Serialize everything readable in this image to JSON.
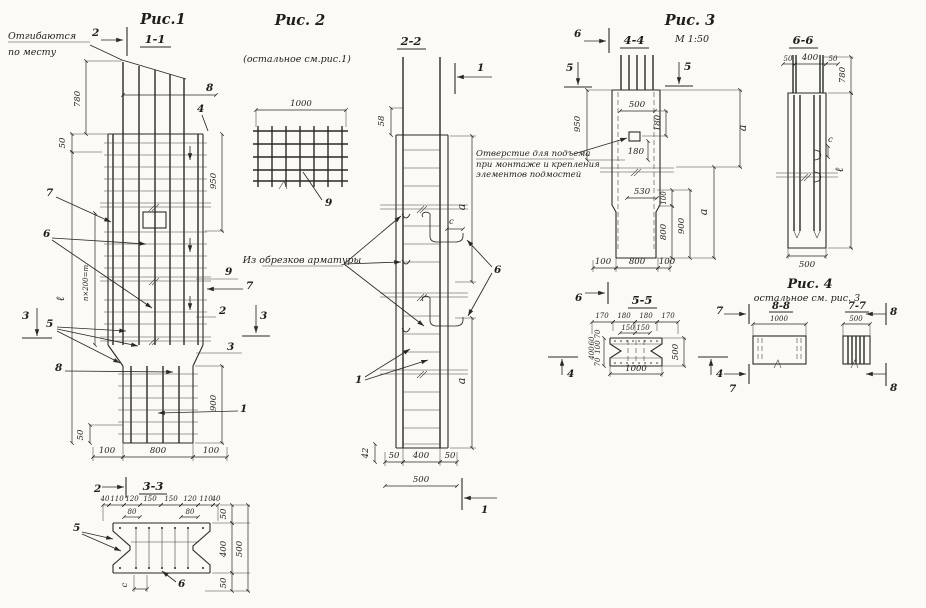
{
  "f1": {
    "title": "Рис.1",
    "sec": "1-1",
    "note1": "Отгибаются",
    "note2": "по месту",
    "cut2": "2",
    "d780": "780",
    "d50top": "50",
    "d8": "8",
    "c4": "4",
    "d950": "950",
    "c7l": "7",
    "c6": "6",
    "c9": "9",
    "c7r": "7",
    "c2": "2",
    "cut3r": "3",
    "c3": "3",
    "dl": "ℓ",
    "dpitch": "n×200=m",
    "cut3l": "3",
    "c5": "5",
    "c8": "8",
    "d900": "900",
    "c1": "1",
    "d50bot": "50",
    "d100l": "100",
    "d800": "800",
    "d100r": "100"
  },
  "s33": {
    "sec": "3-3",
    "cut2": "2",
    "top": [
      "40",
      "110",
      "120",
      "150",
      "150",
      "120",
      "110",
      "40"
    ],
    "d80l": "80",
    "d80r": "80",
    "d50t": "50",
    "d400": "400",
    "d500": "500",
    "d50b": "50",
    "c5": "5",
    "dc": "c",
    "c6": "6"
  },
  "f2": {
    "title": "Рис. 2",
    "note": "(остальное см.рис.1)",
    "d1000": "1000",
    "c9": "9"
  },
  "s22": {
    "sec": "2-2",
    "cut1t": "1",
    "d58": "58",
    "dc": "c",
    "da_top": "a",
    "c6": "6",
    "note": "Из обрезков арматуры",
    "c1": "1",
    "da_bot": "a",
    "d42": "42",
    "d50l": "50",
    "d400": "400",
    "d50r": "50",
    "d500": "500",
    "cut1b": "1"
  },
  "f3": {
    "title": "Рис. 3",
    "scale": "М 1:50",
    "sec": "4-4",
    "cut6t": "6",
    "cut5l": "5",
    "cut5r": "5",
    "d950": "950",
    "d500": "500",
    "d180a": "180",
    "d180b": "180",
    "hole1": "Отверстие для подъема",
    "hole2": "при монтаже и крепления",
    "hole3": "элементов подмостей",
    "da_top": "a",
    "d530": "530",
    "d100": "100",
    "d800": "800",
    "d900": "900",
    "da_bot": "a",
    "b100l": "100",
    "b800": "800",
    "b100r": "100",
    "cut6b": "6"
  },
  "s55": {
    "sec": "5-5",
    "top": [
      "170",
      "180",
      "180",
      "170"
    ],
    "mid": [
      "150",
      "150"
    ],
    "left": [
      "70",
      "60",
      "100",
      "400",
      "70"
    ],
    "d500": "500",
    "d1000": "1000",
    "cut4l": "4",
    "cut4r": "4"
  },
  "s66": {
    "sec": "6-6",
    "d50l": "50",
    "d400": "400",
    "d50r": "50",
    "d780": "780",
    "dc": "c",
    "dl": "ℓ",
    "d500": "500"
  },
  "f4": {
    "title": "Рис. 4",
    "note": "остальное см. рис. 3",
    "s88": "8-8",
    "d1000": "1000",
    "s77": "7-7",
    "d500": "500",
    "cut7t": "7",
    "cut7b": "7",
    "cut8t": "8",
    "cut8b": "8"
  }
}
